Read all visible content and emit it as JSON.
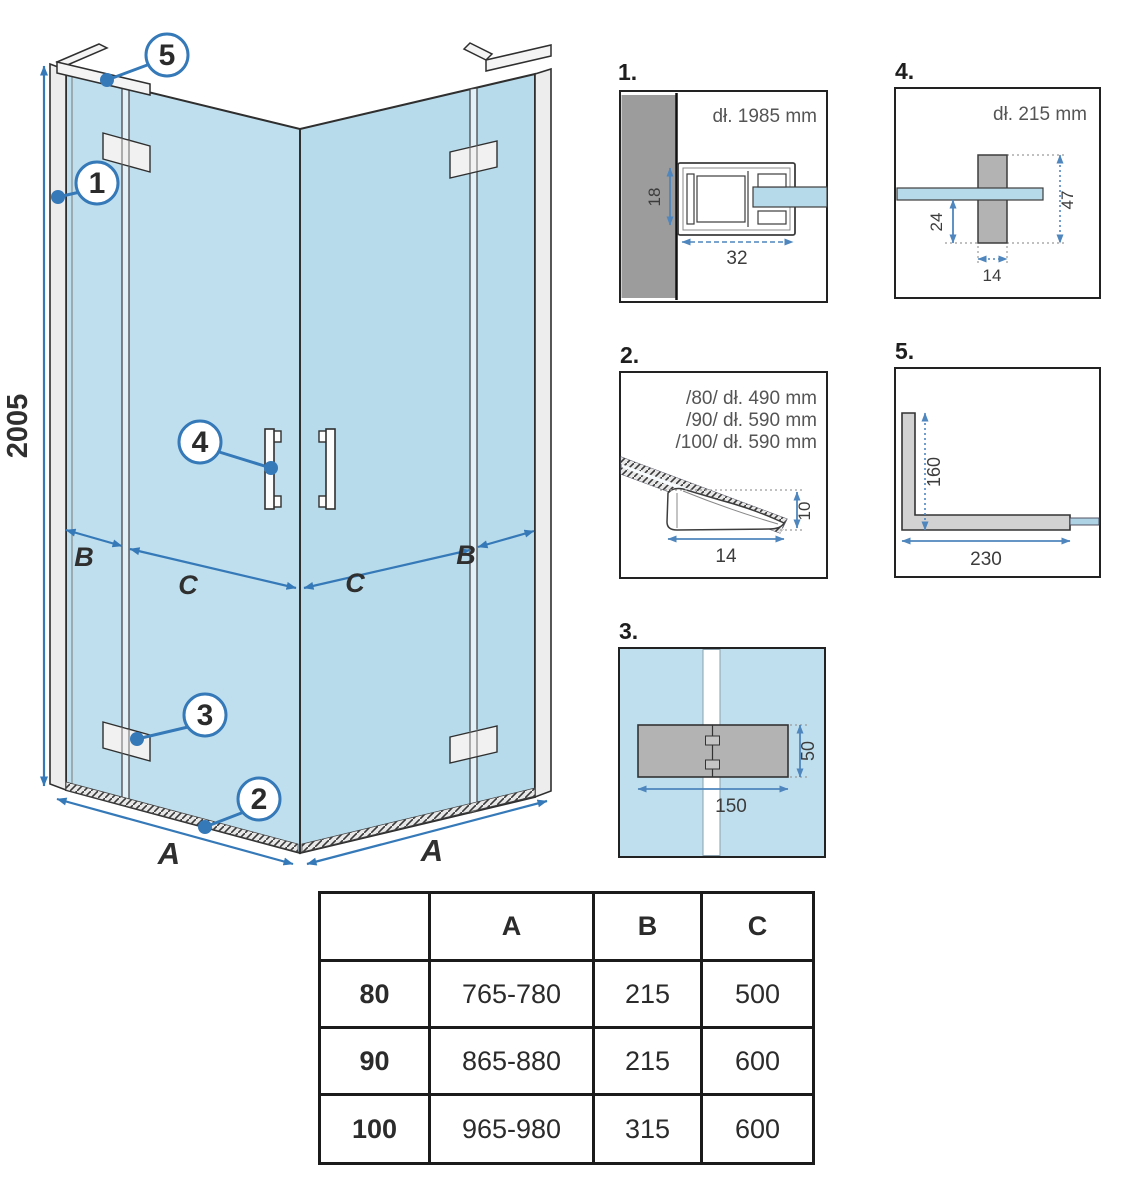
{
  "colors": {
    "glass_blue": "#bfdfee",
    "glass_blue_dark": "#b8dbeb",
    "accent_blue": "#3579b8",
    "detail_dim_blue": "#4e86bd",
    "wall_gray": "#9c9c9c",
    "part_gray": "#b3b3b3",
    "outline_dark": "#333333"
  },
  "main_diagram": {
    "height_dim": "2005",
    "dim_a_left": "A",
    "dim_a_right": "A",
    "dim_b_left": "B",
    "dim_b_right": "B",
    "dim_c_left": "C",
    "dim_c_right": "C",
    "callouts": {
      "c1": "1",
      "c2": "2",
      "c3": "3",
      "c4": "4",
      "c5": "5"
    }
  },
  "details": {
    "d1": {
      "label": "1.",
      "length": "dł. 1985 mm",
      "depth": "18",
      "width": "32"
    },
    "d2": {
      "label": "2.",
      "length_80": "/80/ dł. 490 mm",
      "length_90": "/90/ dł. 590 mm",
      "length_100": "/100/ dł. 590 mm",
      "height": "10",
      "width": "14"
    },
    "d3": {
      "label": "3.",
      "height": "50",
      "width": "150"
    },
    "d4": {
      "label": "4.",
      "length": "dł. 215 mm",
      "offset": "24",
      "height": "47",
      "width": "14"
    },
    "d5": {
      "label": "5.",
      "height": "160",
      "width": "230"
    }
  },
  "table": {
    "headers": {
      "size": "",
      "a": "A",
      "b": "B",
      "c": "C"
    },
    "rows": [
      {
        "size": "80",
        "a": "765-780",
        "b": "215",
        "c": "500"
      },
      {
        "size": "90",
        "a": "865-880",
        "b": "215",
        "c": "600"
      },
      {
        "size": "100",
        "a": "965-980",
        "b": "315",
        "c": "600"
      }
    ]
  }
}
